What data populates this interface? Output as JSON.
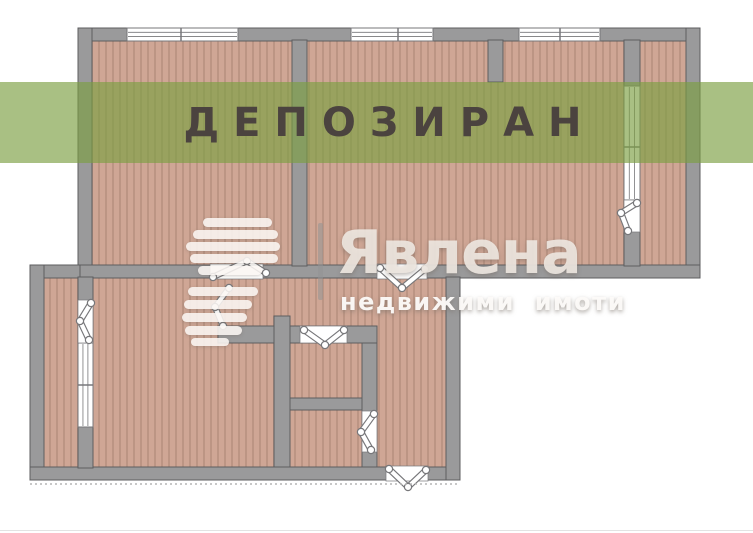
{
  "banner": {
    "text": "ДЕПОЗИРАН"
  },
  "watermark": {
    "brand": "Явлена",
    "tagline": "недвижими имоти",
    "bars": [
      [
        203,
        218,
        69,
        9
      ],
      [
        193,
        230,
        85,
        9
      ],
      [
        186,
        242,
        94,
        9
      ],
      [
        190,
        254,
        88,
        9
      ],
      [
        198,
        266,
        64,
        9
      ],
      [
        188,
        287,
        70,
        9
      ],
      [
        184,
        300,
        68,
        9
      ],
      [
        182,
        313,
        65,
        9
      ],
      [
        185,
        326,
        57,
        9
      ],
      [
        191,
        338,
        38,
        8
      ]
    ],
    "divider": [
      318,
      223,
      5,
      77
    ]
  },
  "colors": {
    "banner_bg": "rgba(124,159,67,0.66)",
    "banner_text": "#4b433f",
    "wall": "#9a9a9b",
    "wall_stroke": "#5d5d5f",
    "floor_base": "#cfa695",
    "floor_stripe": "#b58f7e",
    "symbol_stroke": "#77777a",
    "watermark_text": "rgba(238,232,225,0.9)",
    "tagline_text": "rgba(253,251,249,0.95)",
    "dotted_line": "#b5b5b5"
  },
  "plan": {
    "floors": [
      [
        91,
        40,
        597,
        227
      ],
      [
        43,
        277,
        406,
        192
      ]
    ],
    "walls": [
      [
        78,
        28,
        622,
        13
      ],
      [
        78,
        28,
        14,
        250
      ],
      [
        686,
        28,
        14,
        250
      ],
      [
        78,
        265,
        622,
        13
      ],
      [
        292,
        40,
        15,
        226
      ],
      [
        488,
        40,
        15,
        42
      ],
      [
        624,
        40,
        16,
        226
      ],
      [
        30,
        265,
        50,
        13
      ],
      [
        30,
        265,
        14,
        215
      ],
      [
        30,
        467,
        430,
        13
      ],
      [
        446,
        277,
        14,
        203
      ],
      [
        78,
        277,
        15,
        191
      ],
      [
        218,
        326,
        159,
        17
      ],
      [
        362,
        343,
        15,
        124
      ],
      [
        274,
        316,
        16,
        151
      ],
      [
        290,
        398,
        72,
        12
      ]
    ],
    "windows": [
      {
        "x": 127,
        "y": 28,
        "w": 111,
        "h": 13,
        "dir": "h",
        "mull": [
          181
        ]
      },
      {
        "x": 351,
        "y": 28,
        "w": 82,
        "h": 13,
        "dir": "h",
        "mull": [
          398
        ]
      },
      {
        "x": 519,
        "y": 28,
        "w": 81,
        "h": 13,
        "dir": "h",
        "mull": [
          560
        ]
      },
      {
        "x": 624,
        "y": 86,
        "w": 16,
        "h": 114,
        "dir": "v",
        "mull": [
          147
        ]
      },
      {
        "x": 78,
        "y": 343,
        "w": 15,
        "h": 84,
        "dir": "v",
        "mull": [
          385
        ]
      }
    ],
    "doors": [
      {
        "rect": [
          210,
          264,
          53,
          15
        ],
        "leaf": [
          [
            213,
            277
          ],
          [
            247,
            261
          ],
          [
            266,
            273
          ]
        ]
      },
      {
        "rect": [
          377,
          264,
          50,
          15
        ],
        "leaf": [
          [
            380,
            268
          ],
          [
            402,
            288
          ],
          [
            425,
            269
          ]
        ]
      },
      {
        "rect": [
          624,
          200,
          16,
          32
        ],
        "leaf": [
          [
            637,
            203
          ],
          [
            621,
            213
          ],
          [
            628,
            231
          ]
        ]
      },
      {
        "rect": [
          78,
          300,
          15,
          43
        ],
        "leaf": [
          [
            91,
            303
          ],
          [
            80,
            321
          ],
          [
            89,
            340
          ]
        ]
      },
      {
        "leaf": [
          [
            229,
            288
          ],
          [
            215,
            307
          ],
          [
            223,
            326
          ]
        ]
      },
      {
        "rect": [
          300,
          326,
          47,
          17
        ],
        "leaf": [
          [
            304,
            330
          ],
          [
            325,
            345
          ],
          [
            344,
            330
          ]
        ]
      },
      {
        "rect": [
          362,
          411,
          15,
          41
        ],
        "leaf": [
          [
            374,
            414
          ],
          [
            361,
            432
          ],
          [
            371,
            450
          ]
        ]
      },
      {
        "rect": [
          386,
          466,
          42,
          15
        ],
        "leaf": [
          [
            389,
            469
          ],
          [
            408,
            487
          ],
          [
            426,
            470
          ]
        ]
      }
    ],
    "dotted_line": [
      30,
      484,
      460,
      484
    ]
  }
}
